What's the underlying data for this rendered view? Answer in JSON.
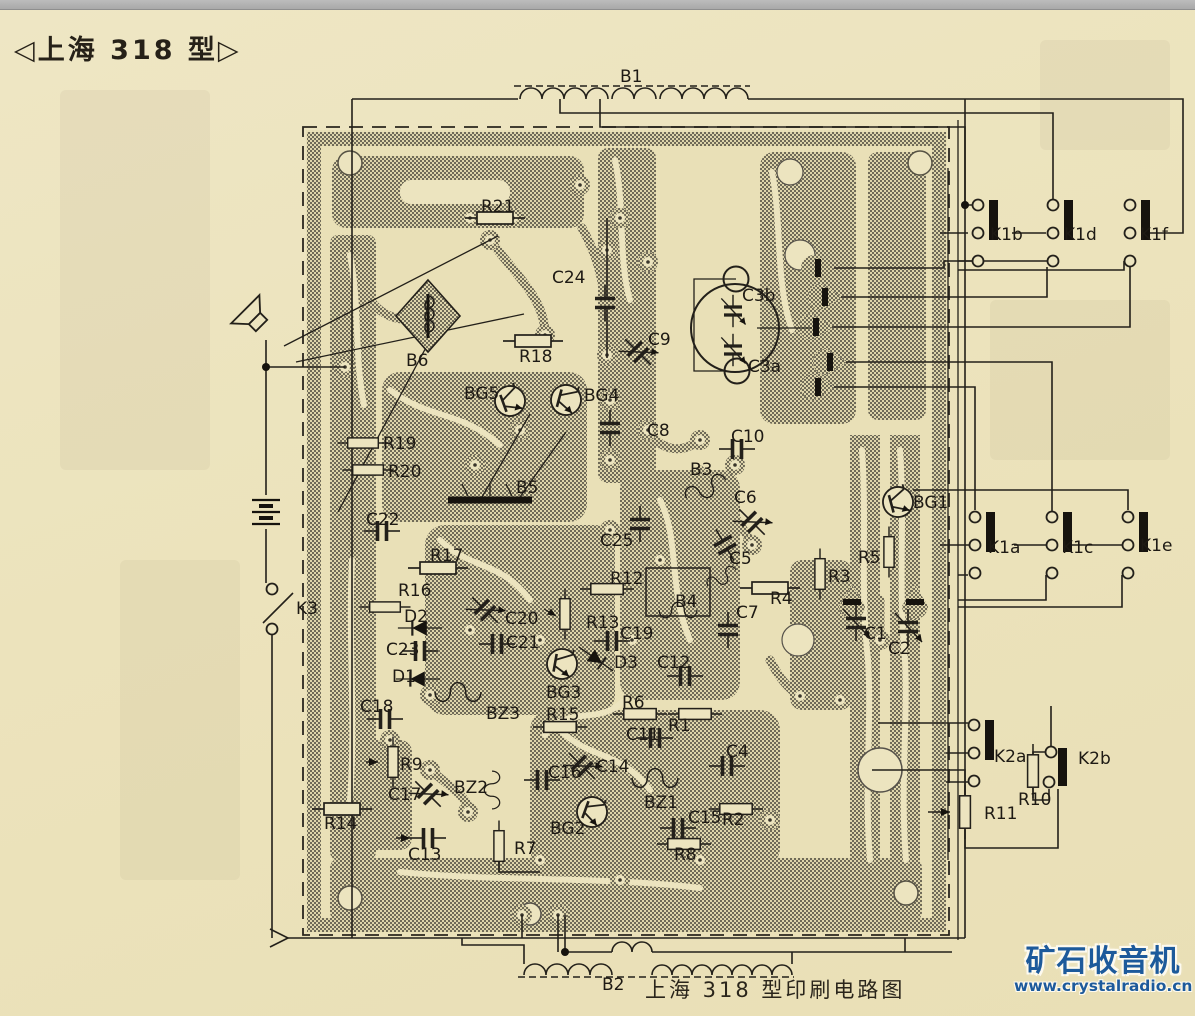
{
  "page": {
    "title": "◁上海 318 型▷",
    "caption": "上海 318 型印刷电路图",
    "watermark": {
      "brand": "矿石收音机",
      "url": "www.crystalradio.cn"
    },
    "colors": {
      "paper": "#ece4bf",
      "ink": "#23201a",
      "copper_hatch": "#6f6a58",
      "watermark_blue": "#1d5a9b",
      "top_bar": "#b3b3b3"
    }
  },
  "diagram": {
    "description": "Printed circuit board layout of Shanghai 318 model radio with copper traces, component symbols and wiring to switch banks",
    "labels": [
      {
        "id": "B1",
        "t": "B1",
        "x": 620,
        "y": 82
      },
      {
        "id": "R21",
        "t": "R21",
        "x": 481,
        "y": 212
      },
      {
        "id": "C24",
        "t": "C24",
        "x": 552,
        "y": 283
      },
      {
        "id": "C3b",
        "t": "C3b",
        "x": 742,
        "y": 301
      },
      {
        "id": "C3a",
        "t": "C3a",
        "x": 748,
        "y": 372
      },
      {
        "id": "B6",
        "t": "B6",
        "x": 406,
        "y": 366
      },
      {
        "id": "R18",
        "t": "R18",
        "x": 519,
        "y": 362
      },
      {
        "id": "C9",
        "t": "C9",
        "x": 648,
        "y": 345
      },
      {
        "id": "BG5",
        "t": "BG5",
        "x": 464,
        "y": 399
      },
      {
        "id": "BG4",
        "t": "BG4",
        "x": 584,
        "y": 401
      },
      {
        "id": "C8",
        "t": "C8",
        "x": 647,
        "y": 436
      },
      {
        "id": "C10",
        "t": "C10",
        "x": 731,
        "y": 442
      },
      {
        "id": "B3",
        "t": "B3",
        "x": 690,
        "y": 475
      },
      {
        "id": "R19",
        "t": "R19",
        "x": 383,
        "y": 449
      },
      {
        "id": "R20",
        "t": "R20",
        "x": 388,
        "y": 477
      },
      {
        "id": "B5",
        "t": "B5",
        "x": 516,
        "y": 493
      },
      {
        "id": "C22",
        "t": "C22",
        "x": 366,
        "y": 525
      },
      {
        "id": "C25",
        "t": "C25",
        "x": 600,
        "y": 546
      },
      {
        "id": "C6",
        "t": "C6",
        "x": 734,
        "y": 503
      },
      {
        "id": "C5",
        "t": "C5",
        "x": 729,
        "y": 564
      },
      {
        "id": "BG1",
        "t": "BG1",
        "x": 913,
        "y": 508
      },
      {
        "id": "K1b",
        "t": "K1b",
        "x": 990,
        "y": 240
      },
      {
        "id": "K1d",
        "t": "K1d",
        "x": 1064,
        "y": 240
      },
      {
        "id": "K1f",
        "t": "K1f",
        "x": 1140,
        "y": 240
      },
      {
        "id": "K1a",
        "t": "K1a",
        "x": 988,
        "y": 553
      },
      {
        "id": "K1c",
        "t": "K1c",
        "x": 1062,
        "y": 553
      },
      {
        "id": "K1e",
        "t": "K1e",
        "x": 1140,
        "y": 551
      },
      {
        "id": "R12",
        "t": "R12",
        "x": 610,
        "y": 584
      },
      {
        "id": "B4",
        "t": "B4",
        "x": 675,
        "y": 607
      },
      {
        "id": "R4",
        "t": "R4",
        "x": 770,
        "y": 604
      },
      {
        "id": "R3",
        "t": "R3",
        "x": 828,
        "y": 582
      },
      {
        "id": "R5",
        "t": "R5",
        "x": 858,
        "y": 563
      },
      {
        "id": "K3",
        "t": "K3",
        "x": 296,
        "y": 614
      },
      {
        "id": "R17",
        "t": "R17",
        "x": 430,
        "y": 561
      },
      {
        "id": "R16",
        "t": "R16",
        "x": 398,
        "y": 596
      },
      {
        "id": "D2",
        "t": "D2",
        "x": 404,
        "y": 622
      },
      {
        "id": "C23",
        "t": "C23",
        "x": 386,
        "y": 655
      },
      {
        "id": "D1",
        "t": "D1",
        "x": 392,
        "y": 682
      },
      {
        "id": "C18",
        "t": "C18",
        "x": 360,
        "y": 712
      },
      {
        "id": "C20",
        "t": "C20",
        "x": 505,
        "y": 624
      },
      {
        "id": "C21",
        "t": "C21",
        "x": 506,
        "y": 648
      },
      {
        "id": "R13",
        "t": "R13",
        "x": 586,
        "y": 628
      },
      {
        "id": "C19",
        "t": "C19",
        "x": 620,
        "y": 639
      },
      {
        "id": "D3",
        "t": "D3",
        "x": 614,
        "y": 668
      },
      {
        "id": "C12",
        "t": "C12",
        "x": 657,
        "y": 668
      },
      {
        "id": "BG3",
        "t": "BG3",
        "x": 546,
        "y": 698
      },
      {
        "id": "BZ3",
        "t": "BZ3",
        "x": 486,
        "y": 719
      },
      {
        "id": "R15",
        "t": "R15",
        "x": 546,
        "y": 720
      },
      {
        "id": "R6",
        "t": "R6",
        "x": 622,
        "y": 708
      },
      {
        "id": "R1",
        "t": "R1",
        "x": 668,
        "y": 731
      },
      {
        "id": "C11",
        "t": "C11",
        "x": 626,
        "y": 740
      },
      {
        "id": "C7",
        "t": "C7",
        "x": 736,
        "y": 618
      },
      {
        "id": "C1",
        "t": "C1",
        "x": 864,
        "y": 639
      },
      {
        "id": "C2",
        "t": "C2",
        "x": 888,
        "y": 654
      },
      {
        "id": "C4",
        "t": "C4",
        "x": 726,
        "y": 757
      },
      {
        "id": "C16",
        "t": "C16",
        "x": 548,
        "y": 778
      },
      {
        "id": "C14",
        "t": "C14",
        "x": 596,
        "y": 772
      },
      {
        "id": "BZ2",
        "t": "BZ2",
        "x": 454,
        "y": 793
      },
      {
        "id": "R9",
        "t": "R9",
        "x": 400,
        "y": 770
      },
      {
        "id": "C17",
        "t": "C17",
        "x": 388,
        "y": 800
      },
      {
        "id": "BZ1",
        "t": "BZ1",
        "x": 644,
        "y": 808
      },
      {
        "id": "C15",
        "t": "C15",
        "x": 688,
        "y": 823
      },
      {
        "id": "R2",
        "t": "R2",
        "x": 722,
        "y": 825
      },
      {
        "id": "BG2",
        "t": "BG2",
        "x": 550,
        "y": 834
      },
      {
        "id": "R14",
        "t": "R14",
        "x": 324,
        "y": 829
      },
      {
        "id": "C13",
        "t": "C13",
        "x": 408,
        "y": 860
      },
      {
        "id": "R7",
        "t": "R7",
        "x": 514,
        "y": 854
      },
      {
        "id": "R8",
        "t": "R8",
        "x": 674,
        "y": 860
      },
      {
        "id": "K2a",
        "t": "K2a",
        "x": 994,
        "y": 762
      },
      {
        "id": "K2b",
        "t": "K2b",
        "x": 1078,
        "y": 764
      },
      {
        "id": "R10",
        "t": "R10",
        "x": 1018,
        "y": 805
      },
      {
        "id": "R11",
        "t": "R11",
        "x": 984,
        "y": 819
      },
      {
        "id": "B2",
        "t": "B2",
        "x": 602,
        "y": 990
      }
    ]
  }
}
